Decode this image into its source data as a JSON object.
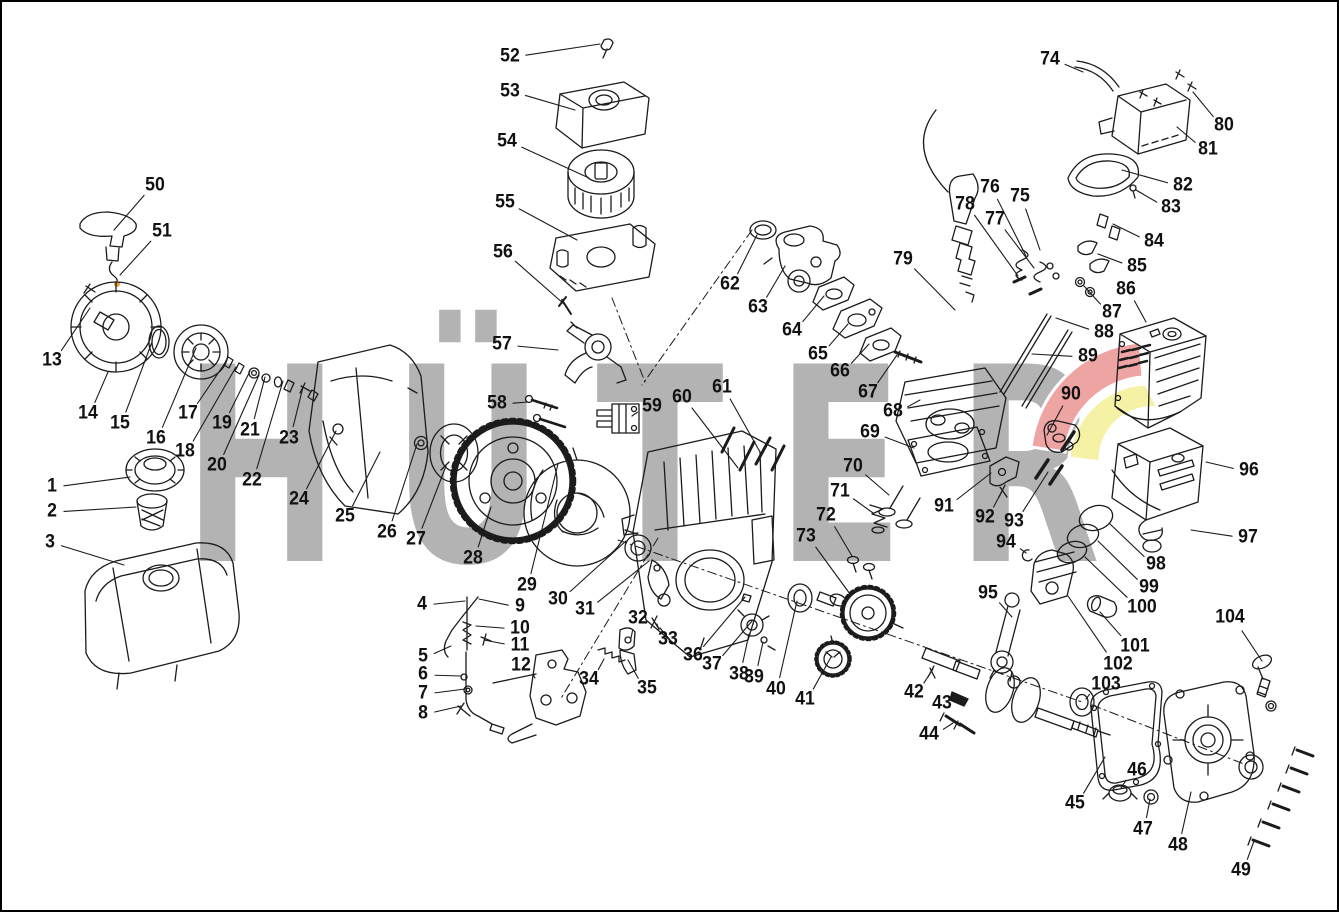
{
  "canvas": {
    "width": 1339,
    "height": 912,
    "background": "#ffffff",
    "frame_color": "#000000"
  },
  "watermark": {
    "text": "HÜTER",
    "color": "#b3b3b3",
    "logo_red": "#efa4a4",
    "logo_yellow": "#f6f2a5",
    "accent_orange": "#e8a33d"
  },
  "diagram": {
    "type": "exploded-parts-diagram",
    "subject": "gasoline engine parts explosion with numbered callouts",
    "line_color": "#1b1b1b",
    "label_color": "#111111",
    "part_count": 104,
    "labels": [
      {
        "n": "1",
        "x": 52,
        "y": 487,
        "tx": 130,
        "ty": 477
      },
      {
        "n": "2",
        "x": 52,
        "y": 512,
        "tx": 136,
        "ty": 507
      },
      {
        "n": "3",
        "x": 50,
        "y": 543,
        "tx": 124,
        "ty": 565
      },
      {
        "n": "4",
        "x": 422,
        "y": 605,
        "tx": 465,
        "ty": 601
      },
      {
        "n": "5",
        "x": 423,
        "y": 657,
        "tx": 451,
        "ty": 646
      },
      {
        "n": "6",
        "x": 423,
        "y": 675,
        "tx": 461,
        "ty": 676
      },
      {
        "n": "7",
        "x": 423,
        "y": 694,
        "tx": 465,
        "ty": 689
      },
      {
        "n": "8",
        "x": 423,
        "y": 714,
        "tx": 461,
        "ty": 706
      },
      {
        "n": "9",
        "x": 520,
        "y": 607,
        "tx": 479,
        "ty": 599
      },
      {
        "n": "10",
        "x": 520,
        "y": 629,
        "tx": 476,
        "ty": 626
      },
      {
        "n": "11",
        "x": 520,
        "y": 646,
        "tx": 484,
        "ty": 640
      },
      {
        "n": "12",
        "x": 521,
        "y": 666,
        "tx": 535,
        "ty": 678
      },
      {
        "n": "13",
        "x": 52,
        "y": 361,
        "tx": 90,
        "ty": 308
      },
      {
        "n": "14",
        "x": 88,
        "y": 414,
        "tx": 108,
        "ty": 372
      },
      {
        "n": "15",
        "x": 120,
        "y": 424,
        "tx": 152,
        "ty": 342
      },
      {
        "n": "16",
        "x": 156,
        "y": 439,
        "tx": 196,
        "ty": 348
      },
      {
        "n": "17",
        "x": 188,
        "y": 414,
        "tx": 227,
        "ty": 360
      },
      {
        "n": "18",
        "x": 185,
        "y": 452,
        "tx": 236,
        "ty": 367
      },
      {
        "n": "19",
        "x": 222,
        "y": 424,
        "tx": 250,
        "ty": 371
      },
      {
        "n": "20",
        "x": 217,
        "y": 466,
        "tx": 259,
        "ty": 375
      },
      {
        "n": "21",
        "x": 250,
        "y": 431,
        "tx": 265,
        "ty": 377
      },
      {
        "n": "22",
        "x": 252,
        "y": 481,
        "tx": 283,
        "ty": 381
      },
      {
        "n": "23",
        "x": 289,
        "y": 439,
        "tx": 303,
        "ty": 387
      },
      {
        "n": "24",
        "x": 299,
        "y": 500,
        "tx": 336,
        "ty": 431
      },
      {
        "n": "25",
        "x": 345,
        "y": 517,
        "tx": 380,
        "ty": 452
      },
      {
        "n": "26",
        "x": 387,
        "y": 533,
        "tx": 417,
        "ty": 444
      },
      {
        "n": "27",
        "x": 416,
        "y": 540,
        "tx": 446,
        "ty": 466
      },
      {
        "n": "28",
        "x": 473,
        "y": 559,
        "tx": 491,
        "ty": 507
      },
      {
        "n": "29",
        "x": 527,
        "y": 586,
        "tx": 558,
        "ty": 464
      },
      {
        "n": "30",
        "x": 558,
        "y": 600,
        "tx": 626,
        "ty": 541
      },
      {
        "n": "31",
        "x": 585,
        "y": 610,
        "tx": 649,
        "ty": 561
      },
      {
        "n": "32",
        "x": 638,
        "y": 619,
        "tx": 631,
        "ty": 638
      },
      {
        "n": "33",
        "x": 668,
        "y": 640,
        "tx": 657,
        "ty": 624
      },
      {
        "n": "34",
        "x": 589,
        "y": 680,
        "tx": 604,
        "ty": 659
      },
      {
        "n": "35",
        "x": 647,
        "y": 689,
        "tx": 628,
        "ty": 660
      },
      {
        "n": "36",
        "x": 693,
        "y": 656,
        "tx": 745,
        "ty": 597
      },
      {
        "n": "37",
        "x": 712,
        "y": 665,
        "tx": 752,
        "ty": 621
      },
      {
        "n": "38",
        "x": 739,
        "y": 675,
        "tx": 749,
        "ty": 634
      },
      {
        "n": "39",
        "x": 754,
        "y": 678,
        "tx": 763,
        "ty": 642
      },
      {
        "n": "40",
        "x": 776,
        "y": 690,
        "tx": 797,
        "ty": 601
      },
      {
        "n": "41",
        "x": 805,
        "y": 700,
        "tx": 831,
        "ty": 657
      },
      {
        "n": "42",
        "x": 914,
        "y": 693,
        "tx": 933,
        "ty": 669
      },
      {
        "n": "43",
        "x": 942,
        "y": 704,
        "tx": 958,
        "ty": 697
      },
      {
        "n": "44",
        "x": 929,
        "y": 735,
        "tx": 953,
        "ty": 723
      },
      {
        "n": "45",
        "x": 1075,
        "y": 804,
        "tx": 1105,
        "ty": 757
      },
      {
        "n": "46",
        "x": 1137,
        "y": 771,
        "tx": 1121,
        "ty": 788
      },
      {
        "n": "47",
        "x": 1143,
        "y": 830,
        "tx": 1150,
        "ty": 799
      },
      {
        "n": "48",
        "x": 1178,
        "y": 846,
        "tx": 1191,
        "ty": 792
      },
      {
        "n": "49",
        "x": 1241,
        "y": 871,
        "tx": 1254,
        "ty": 841
      },
      {
        "n": "50",
        "x": 155,
        "y": 186,
        "tx": 114,
        "ty": 230
      },
      {
        "n": "51",
        "x": 162,
        "y": 232,
        "tx": 120,
        "ty": 275
      },
      {
        "n": "52",
        "x": 510,
        "y": 57,
        "tx": 600,
        "ty": 44
      },
      {
        "n": "53",
        "x": 510,
        "y": 92,
        "tx": 575,
        "ty": 110
      },
      {
        "n": "54",
        "x": 507,
        "y": 142,
        "tx": 589,
        "ty": 178
      },
      {
        "n": "55",
        "x": 505,
        "y": 203,
        "tx": 577,
        "ty": 240
      },
      {
        "n": "56",
        "x": 503,
        "y": 253,
        "tx": 564,
        "ty": 304
      },
      {
        "n": "57",
        "x": 502,
        "y": 345,
        "tx": 558,
        "ty": 350
      },
      {
        "n": "58",
        "x": 497,
        "y": 404,
        "tx": 528,
        "ty": 402
      },
      {
        "n": "59",
        "x": 652,
        "y": 407,
        "tx": 632,
        "ty": 416
      },
      {
        "n": "60",
        "x": 682,
        "y": 398,
        "tx": 738,
        "ty": 468
      },
      {
        "n": "61",
        "x": 722,
        "y": 388,
        "tx": 760,
        "ty": 452
      },
      {
        "n": "62",
        "x": 730,
        "y": 285,
        "tx": 757,
        "ty": 235
      },
      {
        "n": "63",
        "x": 758,
        "y": 308,
        "tx": 785,
        "ty": 266
      },
      {
        "n": "64",
        "x": 792,
        "y": 331,
        "tx": 824,
        "ty": 296
      },
      {
        "n": "65",
        "x": 818,
        "y": 355,
        "tx": 848,
        "ty": 324
      },
      {
        "n": "66",
        "x": 840,
        "y": 372,
        "tx": 869,
        "ty": 344
      },
      {
        "n": "67",
        "x": 868,
        "y": 393,
        "tx": 897,
        "ty": 355
      },
      {
        "n": "68",
        "x": 893,
        "y": 412,
        "tx": 920,
        "ty": 400
      },
      {
        "n": "69",
        "x": 870,
        "y": 433,
        "tx": 914,
        "ty": 448
      },
      {
        "n": "70",
        "x": 853,
        "y": 467,
        "tx": 889,
        "ty": 495
      },
      {
        "n": "71",
        "x": 840,
        "y": 492,
        "tx": 873,
        "ty": 513
      },
      {
        "n": "72",
        "x": 826,
        "y": 516,
        "tx": 852,
        "ty": 556
      },
      {
        "n": "73",
        "x": 806,
        "y": 537,
        "tx": 850,
        "ty": 594
      },
      {
        "n": "74",
        "x": 1050,
        "y": 60,
        "tx": 1083,
        "ty": 72
      },
      {
        "n": "75",
        "x": 1020,
        "y": 197,
        "tx": 1040,
        "ty": 250
      },
      {
        "n": "76",
        "x": 990,
        "y": 188,
        "tx": 1026,
        "ty": 256
      },
      {
        "n": "77",
        "x": 995,
        "y": 220,
        "tx": 1034,
        "ty": 268
      },
      {
        "n": "78",
        "x": 965,
        "y": 205,
        "tx": 1018,
        "ty": 276
      },
      {
        "n": "79",
        "x": 903,
        "y": 260,
        "tx": 955,
        "ty": 310
      },
      {
        "n": "80",
        "x": 1224,
        "y": 126,
        "tx": 1193,
        "ty": 92
      },
      {
        "n": "81",
        "x": 1208,
        "y": 150,
        "tx": 1177,
        "ty": 127
      },
      {
        "n": "82",
        "x": 1183,
        "y": 186,
        "tx": 1122,
        "ty": 170
      },
      {
        "n": "83",
        "x": 1171,
        "y": 208,
        "tx": 1136,
        "ty": 190
      },
      {
        "n": "84",
        "x": 1154,
        "y": 242,
        "tx": 1113,
        "ty": 224
      },
      {
        "n": "85",
        "x": 1137,
        "y": 267,
        "tx": 1098,
        "ty": 254
      },
      {
        "n": "86",
        "x": 1126,
        "y": 290,
        "tx": 1146,
        "ty": 322
      },
      {
        "n": "87",
        "x": 1112,
        "y": 313,
        "tx": 1084,
        "ty": 286
      },
      {
        "n": "88",
        "x": 1104,
        "y": 333,
        "tx": 1056,
        "ty": 318
      },
      {
        "n": "89",
        "x": 1088,
        "y": 357,
        "tx": 1032,
        "ty": 354
      },
      {
        "n": "90",
        "x": 1071,
        "y": 395,
        "tx": 1047,
        "ty": 435
      },
      {
        "n": "91",
        "x": 944,
        "y": 507,
        "tx": 991,
        "ty": 473
      },
      {
        "n": "92",
        "x": 985,
        "y": 518,
        "tx": 1002,
        "ty": 491
      },
      {
        "n": "93",
        "x": 1014,
        "y": 522,
        "tx": 1048,
        "ty": 472
      },
      {
        "n": "94",
        "x": 1006,
        "y": 543,
        "tx": 1026,
        "ty": 553
      },
      {
        "n": "95",
        "x": 988,
        "y": 594,
        "tx": 1012,
        "ty": 617
      },
      {
        "n": "96",
        "x": 1249,
        "y": 471,
        "tx": 1206,
        "ty": 462
      },
      {
        "n": "97",
        "x": 1248,
        "y": 538,
        "tx": 1191,
        "ty": 530
      },
      {
        "n": "98",
        "x": 1156,
        "y": 565,
        "tx": 1110,
        "ty": 524
      },
      {
        "n": "99",
        "x": 1149,
        "y": 588,
        "tx": 1098,
        "ty": 541
      },
      {
        "n": "100",
        "x": 1142,
        "y": 608,
        "tx": 1085,
        "ty": 557
      },
      {
        "n": "101",
        "x": 1135,
        "y": 647,
        "tx": 1100,
        "ty": 612
      },
      {
        "n": "102",
        "x": 1118,
        "y": 665,
        "tx": 1068,
        "ty": 596
      },
      {
        "n": "103",
        "x": 1106,
        "y": 685,
        "tx": 1086,
        "ty": 699
      },
      {
        "n": "104",
        "x": 1230,
        "y": 618,
        "tx": 1262,
        "ty": 661
      }
    ]
  }
}
